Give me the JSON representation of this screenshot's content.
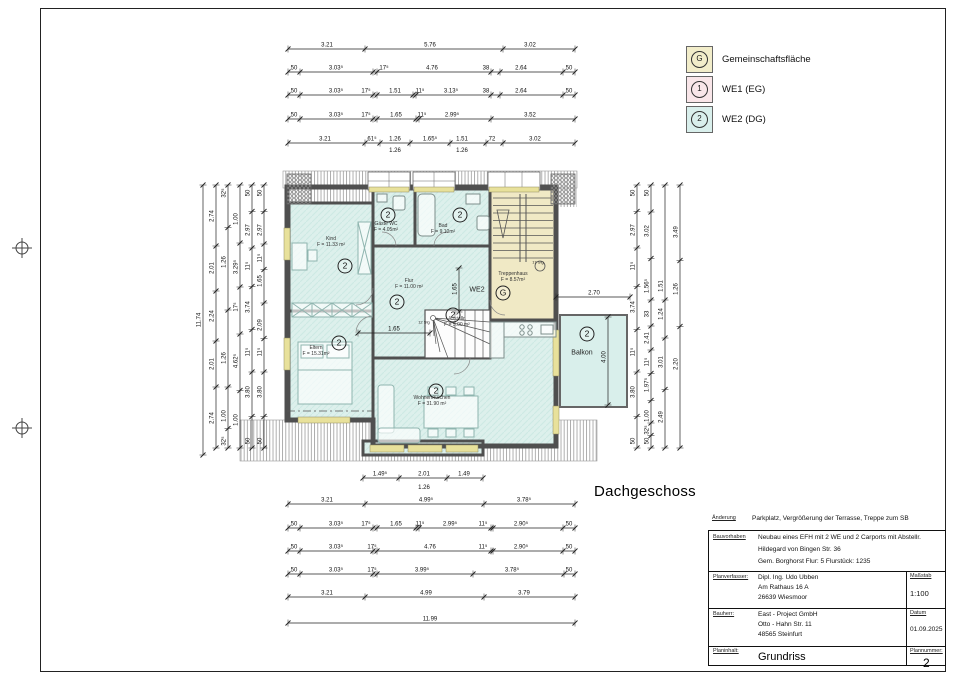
{
  "floor_label": "Dachgeschoss",
  "colors": {
    "room_fill": "#ddf0ec",
    "stair_fill": "#f0e9c5",
    "wall": "#4f4f4f",
    "window_sill": "#e8e19b",
    "legend_g": "#f2edca",
    "legend_we1": "#f9e6e9",
    "legend_we2": "#d9efec"
  },
  "legend": {
    "items": [
      {
        "symbol": "G",
        "label": "Gemeinschaftsfläche",
        "color": "#f2edca"
      },
      {
        "symbol": "1",
        "label": "WE1 (EG)",
        "color": "#f9e6e9"
      },
      {
        "symbol": "2",
        "label": "WE2 (DG)",
        "color": "#d9efec"
      }
    ]
  },
  "title_block": {
    "aenderung_label": "Änderung",
    "aenderung": "Parkplatz, Vergrößerung der Terrasse, Treppe zum SB",
    "bauvorhaben_label": "Bauvorhaben",
    "bauvorhaben_line1": "Neubau eines EFH mit 2 WE und 2 Carports mit Abstellr.",
    "bauvorhaben_line2": "Hildegard von Bingen Str. 36",
    "bauvorhaben_line3": "Gem. Borghorst   Flur: 5   Flurstück: 1235",
    "planverfasser_label": "Planverfasser:",
    "planverfasser_line1": "Dipl. Ing. Udo Ubben",
    "planverfasser_line2": "Am Rathaus 16 A",
    "planverfasser_line3": "26639 Wiesmoor",
    "massstab_label": "Maßstab",
    "massstab": "1:100",
    "bauherr_label": "Bauherr:",
    "bauherr_line1": "East - Project GmbH",
    "bauherr_line2": "Otto - Hahn Str. 11",
    "bauherr_line3": "48565 Steinfurt",
    "datum_label": "Datum",
    "datum": "01.09.2025",
    "planinhalt_label": "Planinhalt:",
    "planinhalt": "Grundriss",
    "plannummer_label": "Plannummer:",
    "plannummer": "2"
  },
  "plan": {
    "rooms": [
      {
        "name": "Kind",
        "area": "F = 11.33 m²",
        "x": 331,
        "y": 242
      },
      {
        "name": "Gäste WC",
        "area": "F = 4.05m²",
        "x": 386,
        "y": 227
      },
      {
        "name": "Bad",
        "area": "F = 9.10m²",
        "x": 443,
        "y": 229
      },
      {
        "name": "Treppenhaus",
        "area": "F = 8.57m²",
        "x": 513,
        "y": 277
      },
      {
        "name": "Flur",
        "area": "F = 11.00 m²",
        "x": 409,
        "y": 284
      },
      {
        "name": "Abstellr.",
        "area": "F = 5.00 m²",
        "x": 457,
        "y": 322
      },
      {
        "name": "Eltern",
        "area": "F = 15.31m²",
        "x": 316,
        "y": 351
      },
      {
        "name": "Wohnen/Küchen",
        "area": "F = 31.90 m²",
        "x": 432,
        "y": 401
      }
    ],
    "badges": [
      {
        "s": "2",
        "x": 345,
        "y": 266
      },
      {
        "s": "2",
        "x": 388,
        "y": 215
      },
      {
        "s": "2",
        "x": 460,
        "y": 215
      },
      {
        "s": "2",
        "x": 397,
        "y": 302
      },
      {
        "s": "2",
        "x": 453,
        "y": 315
      },
      {
        "s": "2",
        "x": 339,
        "y": 343
      },
      {
        "s": "2",
        "x": 436,
        "y": 391
      },
      {
        "s": "2",
        "x": 587,
        "y": 334
      },
      {
        "s": "G",
        "x": 503,
        "y": 293
      }
    ],
    "texts": [
      {
        "t": "WE2",
        "x": 477,
        "y": 290,
        "s": 7
      },
      {
        "t": "Balkon",
        "x": 582,
        "y": 353,
        "s": 7
      },
      {
        "t": "12 Stg",
        "x": 424,
        "y": 322,
        "s": 4
      },
      {
        "t": "17 Stg",
        "x": 538,
        "y": 262,
        "s": 4
      }
    ]
  },
  "dims": {
    "chains": [
      {
        "o": "h",
        "y": 49,
        "x1": 288,
        "x2": 575,
        "ticks": [
          288,
          365,
          503,
          575
        ],
        "labels": [
          {
            "t": "3.21",
            "p": 327
          },
          {
            "t": "5.76",
            "p": 430
          },
          {
            "t": "3.02",
            "p": 530
          }
        ]
      },
      {
        "o": "h",
        "y": 72,
        "x1": 288,
        "x2": 575,
        "ticks": [
          288,
          300,
          373,
          377,
          491,
          500,
          563,
          575
        ],
        "labels": [
          {
            "t": "50",
            "p": 294
          },
          {
            "t": "3.03⁵",
            "p": 336
          },
          {
            "t": "17⁵",
            "p": 384
          },
          {
            "t": "4.76",
            "p": 432
          },
          {
            "t": "38",
            "p": 486
          },
          {
            "t": "2.64",
            "p": 521
          },
          {
            "t": "50",
            "p": 569
          }
        ]
      },
      {
        "o": "h",
        "y": 95,
        "x1": 288,
        "x2": 575,
        "ticks": [
          288,
          300,
          373,
          377,
          413,
          416,
          491,
          500,
          563,
          575
        ],
        "labels": [
          {
            "t": "50",
            "p": 294
          },
          {
            "t": "3.03⁵",
            "p": 336
          },
          {
            "t": "17⁵",
            "p": 366
          },
          {
            "t": "1.51",
            "p": 395
          },
          {
            "t": "11⁵",
            "p": 420
          },
          {
            "t": "3.13⁵",
            "p": 451
          },
          {
            "t": "38",
            "p": 486
          },
          {
            "t": "2.64",
            "p": 521
          },
          {
            "t": "50",
            "p": 569
          }
        ]
      },
      {
        "o": "h",
        "y": 119,
        "x1": 288,
        "x2": 575,
        "ticks": [
          288,
          300,
          373,
          377,
          416,
          419,
          491,
          575
        ],
        "labels": [
          {
            "t": "50",
            "p": 294
          },
          {
            "t": "3.03⁵",
            "p": 336
          },
          {
            "t": "17⁵",
            "p": 366
          },
          {
            "t": "1.65",
            "p": 396
          },
          {
            "t": "11⁵",
            "p": 422
          },
          {
            "t": "2.99⁵",
            "p": 452
          },
          {
            "t": "3.52",
            "p": 530
          }
        ]
      },
      {
        "o": "h",
        "y": 143,
        "x1": 288,
        "x2": 575,
        "ticks": [
          288,
          365,
          380,
          410,
          450,
          486,
          503,
          575
        ],
        "labels": [
          {
            "t": "3.21",
            "p": 325
          },
          {
            "t": "61⁵",
            "p": 372
          },
          {
            "t": "1.26",
            "p": 395
          },
          {
            "t": "1.65⁵",
            "p": 430
          },
          {
            "t": "1.51",
            "p": 462
          },
          {
            "t": "72",
            "p": 492
          },
          {
            "t": "3.02",
            "p": 535
          }
        ]
      },
      {
        "o": "h",
        "y": 478,
        "x1": 363,
        "x2": 483,
        "ticks": [
          363,
          399,
          447,
          483
        ],
        "labels": [
          {
            "t": "1.49⁵",
            "p": 380
          },
          {
            "t": "2.01",
            "p": 424
          },
          {
            "t": "1.49",
            "p": 464
          }
        ]
      },
      {
        "o": "h",
        "y": 504,
        "x1": 288,
        "x2": 575,
        "ticks": [
          288,
          365,
          484,
          575
        ],
        "labels": [
          {
            "t": "3.21",
            "p": 327
          },
          {
            "t": "4.99⁵",
            "p": 426
          },
          {
            "t": "3.78⁵",
            "p": 524
          }
        ]
      },
      {
        "o": "h",
        "y": 528,
        "x1": 288,
        "x2": 575,
        "ticks": [
          288,
          300,
          373,
          377,
          416,
          419,
          491,
          493,
          563,
          575
        ],
        "labels": [
          {
            "t": "50",
            "p": 294
          },
          {
            "t": "3.03⁵",
            "p": 336
          },
          {
            "t": "17⁵",
            "p": 366
          },
          {
            "t": "1.65",
            "p": 396
          },
          {
            "t": "11⁵",
            "p": 420
          },
          {
            "t": "2.99⁵",
            "p": 450
          },
          {
            "t": "11⁵",
            "p": 483
          },
          {
            "t": "2.90⁵",
            "p": 521
          },
          {
            "t": "50",
            "p": 569
          }
        ]
      },
      {
        "o": "h",
        "y": 551,
        "x1": 288,
        "x2": 575,
        "ticks": [
          288,
          300,
          373,
          377,
          491,
          493,
          563,
          575
        ],
        "labels": [
          {
            "t": "50",
            "p": 294
          },
          {
            "t": "3.03⁵",
            "p": 336
          },
          {
            "t": "17⁵",
            "p": 372
          },
          {
            "t": "4.76",
            "p": 430
          },
          {
            "t": "11⁵",
            "p": 483
          },
          {
            "t": "2.90⁵",
            "p": 521
          },
          {
            "t": "50",
            "p": 569
          }
        ]
      },
      {
        "o": "h",
        "y": 574,
        "x1": 288,
        "x2": 575,
        "ticks": [
          288,
          300,
          373,
          377,
          473,
          564,
          575
        ],
        "labels": [
          {
            "t": "50",
            "p": 294
          },
          {
            "t": "3.03⁵",
            "p": 336
          },
          {
            "t": "17⁵",
            "p": 372
          },
          {
            "t": "3.99⁵",
            "p": 422
          },
          {
            "t": "3.78⁵",
            "p": 512
          },
          {
            "t": "50",
            "p": 569
          }
        ]
      },
      {
        "o": "h",
        "y": 597,
        "x1": 288,
        "x2": 575,
        "ticks": [
          288,
          365,
          484,
          575
        ],
        "labels": [
          {
            "t": "3.21",
            "p": 327
          },
          {
            "t": "4.99",
            "p": 426
          },
          {
            "t": "3.79",
            "p": 524
          }
        ]
      },
      {
        "o": "h",
        "y": 623,
        "x1": 288,
        "x2": 575,
        "ticks": [
          288,
          575
        ],
        "labels": [
          {
            "t": "11.99",
            "p": 430
          }
        ]
      },
      {
        "o": "v",
        "x": 203,
        "y1": 185,
        "y2": 455,
        "ticks": [
          185,
          455
        ],
        "labels": [
          {
            "t": "11.74",
            "p": 320
          }
        ]
      },
      {
        "o": "v",
        "x": 216,
        "y1": 185,
        "y2": 448,
        "ticks": [
          185,
          246,
          291,
          341,
          387,
          448
        ],
        "labels": [
          {
            "t": "2.74",
            "p": 216
          },
          {
            "t": "2.01",
            "p": 268
          },
          {
            "t": "2.24",
            "p": 316
          },
          {
            "t": "2.01",
            "p": 364
          },
          {
            "t": "2.74",
            "p": 418
          }
        ]
      },
      {
        "o": "v",
        "x": 228,
        "y1": 185,
        "y2": 448,
        "labels": [
          {
            "t": "32⁵",
            "p": 193
          },
          {
            "t": "1.26",
            "p": 262
          },
          {
            "t": "1.26",
            "p": 358
          },
          {
            "t": "1.00",
            "p": 416
          },
          {
            "t": "32⁵",
            "p": 441
          }
        ]
      },
      {
        "o": "v",
        "x": 240,
        "y1": 185,
        "y2": 448,
        "labels": [
          {
            "t": "1.00",
            "p": 219
          },
          {
            "t": "3.29⁵",
            "p": 267
          },
          {
            "t": "17⁵",
            "p": 307
          },
          {
            "t": "4.62⁵",
            "p": 361
          },
          {
            "t": "1.00",
            "p": 420
          }
        ]
      },
      {
        "o": "v",
        "x": 252,
        "y1": 185,
        "y2": 448,
        "labels": [
          {
            "t": "50",
            "p": 193
          },
          {
            "t": "2.97",
            "p": 230
          },
          {
            "t": "11⁵",
            "p": 266
          },
          {
            "t": "3.74",
            "p": 307
          },
          {
            "t": "11⁵",
            "p": 352
          },
          {
            "t": "3.80",
            "p": 392
          },
          {
            "t": "50",
            "p": 441
          }
        ]
      },
      {
        "o": "v",
        "x": 264,
        "y1": 185,
        "y2": 448,
        "labels": [
          {
            "t": "50",
            "p": 193
          },
          {
            "t": "2.97",
            "p": 230
          },
          {
            "t": "11⁵",
            "p": 258
          },
          {
            "t": "1.65",
            "p": 281
          },
          {
            "t": "2.09",
            "p": 325
          },
          {
            "t": "11⁵",
            "p": 352
          },
          {
            "t": "3.80",
            "p": 392
          },
          {
            "t": "50",
            "p": 441
          }
        ]
      },
      {
        "o": "v",
        "x": 637,
        "y1": 185,
        "y2": 448,
        "labels": [
          {
            "t": "50",
            "p": 193
          },
          {
            "t": "2.97",
            "p": 230
          },
          {
            "t": "11⁵",
            "p": 266
          },
          {
            "t": "3.74",
            "p": 307
          },
          {
            "t": "11⁵",
            "p": 352
          },
          {
            "t": "3.80",
            "p": 392
          },
          {
            "t": "50",
            "p": 441
          }
        ]
      },
      {
        "o": "v",
        "x": 651,
        "y1": 185,
        "y2": 448,
        "labels": [
          {
            "t": "50",
            "p": 193
          },
          {
            "t": "3.02",
            "p": 231
          },
          {
            "t": "1.56⁵",
            "p": 286
          },
          {
            "t": "33",
            "p": 314
          },
          {
            "t": "2.41",
            "p": 338
          },
          {
            "t": "11⁵",
            "p": 362
          },
          {
            "t": "1.97⁵",
            "p": 385
          },
          {
            "t": "1.00",
            "p": 416
          },
          {
            "t": "32⁵",
            "p": 430
          },
          {
            "t": "50",
            "p": 441
          }
        ]
      },
      {
        "o": "v",
        "x": 665,
        "y1": 185,
        "y2": 448,
        "labels": [
          {
            "t": "1.51",
            "p": 286
          },
          {
            "t": "1.24",
            "p": 314
          },
          {
            "t": "3.01",
            "p": 362
          },
          {
            "t": "2.49",
            "p": 417
          }
        ]
      },
      {
        "o": "v",
        "x": 680,
        "y1": 185,
        "y2": 448,
        "labels": [
          {
            "t": "3.49",
            "p": 232
          },
          {
            "t": "1.26",
            "p": 289
          },
          {
            "t": "2.20",
            "p": 364
          }
        ]
      },
      {
        "o": "h",
        "y": 333,
        "x1": 358,
        "x2": 430,
        "ticks": [
          358,
          430
        ],
        "labels": [
          {
            "t": "1.65",
            "p": 394
          }
        ]
      },
      {
        "o": "v",
        "x": 459,
        "y1": 268,
        "y2": 312,
        "ticks": [
          268,
          312
        ],
        "labels": [
          {
            "t": "1.65",
            "p": 289
          }
        ]
      },
      {
        "o": "h",
        "y": 297,
        "x1": 556,
        "x2": 630,
        "ticks": [
          556,
          630
        ],
        "labels": [
          {
            "t": "2.70",
            "p": 594
          }
        ]
      },
      {
        "o": "v",
        "x": 608,
        "y1": 317,
        "y2": 405,
        "ticks": [
          317,
          405
        ],
        "labels": [
          {
            "t": "4.00",
            "p": 357
          }
        ]
      }
    ],
    "free": [
      {
        "t": "1.26",
        "x": 395,
        "y": 152
      },
      {
        "t": "1.26",
        "x": 462,
        "y": 152
      },
      {
        "t": "1.26",
        "x": 424,
        "y": 489
      }
    ]
  }
}
